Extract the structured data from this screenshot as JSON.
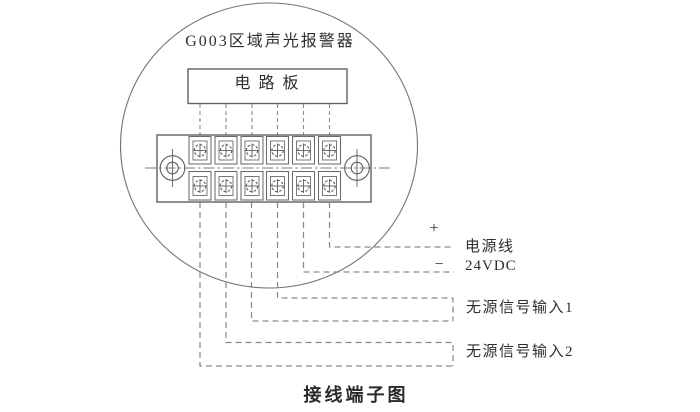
{
  "diagram": {
    "device_title": "G003区域声光报警器",
    "circuit_board_label": "电路板",
    "caption": "接线端子图",
    "terminal_block": {
      "columns": 6,
      "rows": 2,
      "terminal_count": 12
    },
    "connections": {
      "power": {
        "plus_sign": "+",
        "minus_sign": "−",
        "label_line1": "电源线",
        "label_line2": "24VDC"
      },
      "signal_input_1": {
        "label": "无源信号输入1"
      },
      "signal_input_2": {
        "label": "无源信号输入2"
      }
    },
    "colors": {
      "background": "#ffffff",
      "solid_line": "#5f6062",
      "dashed_line": "#8a8a8a",
      "text": "#2e2e2e"
    }
  }
}
